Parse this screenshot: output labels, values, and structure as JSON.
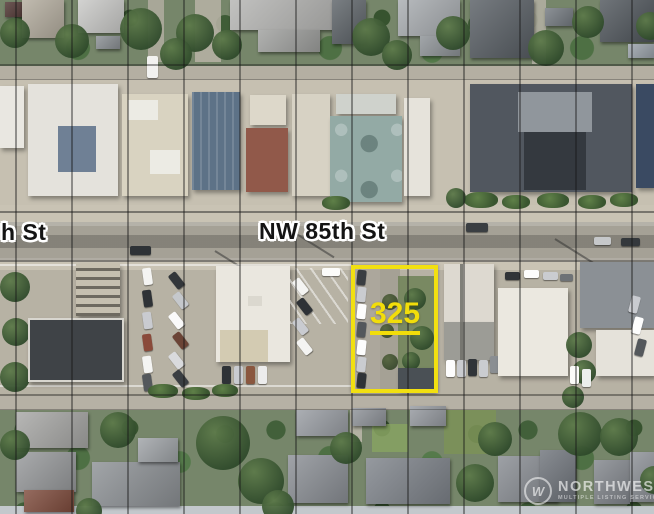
{
  "labels": {
    "street_main": "NW 85th St",
    "street_partial": "h St",
    "parcel_number": "325"
  },
  "watermark": {
    "logo_letter": "W",
    "name": "NORTHWEST",
    "subtitle": "MULTIPLE LISTING SERVICE"
  },
  "colors": {
    "parcel_highlight": "#F2E011",
    "parcel_number_text": "#F2DD0A",
    "street_label_text": "#141414",
    "street_label_outline": "#FFFFFF",
    "parcel_grid_line": "#161616",
    "watermark_text": "#FFFFFF"
  }
}
